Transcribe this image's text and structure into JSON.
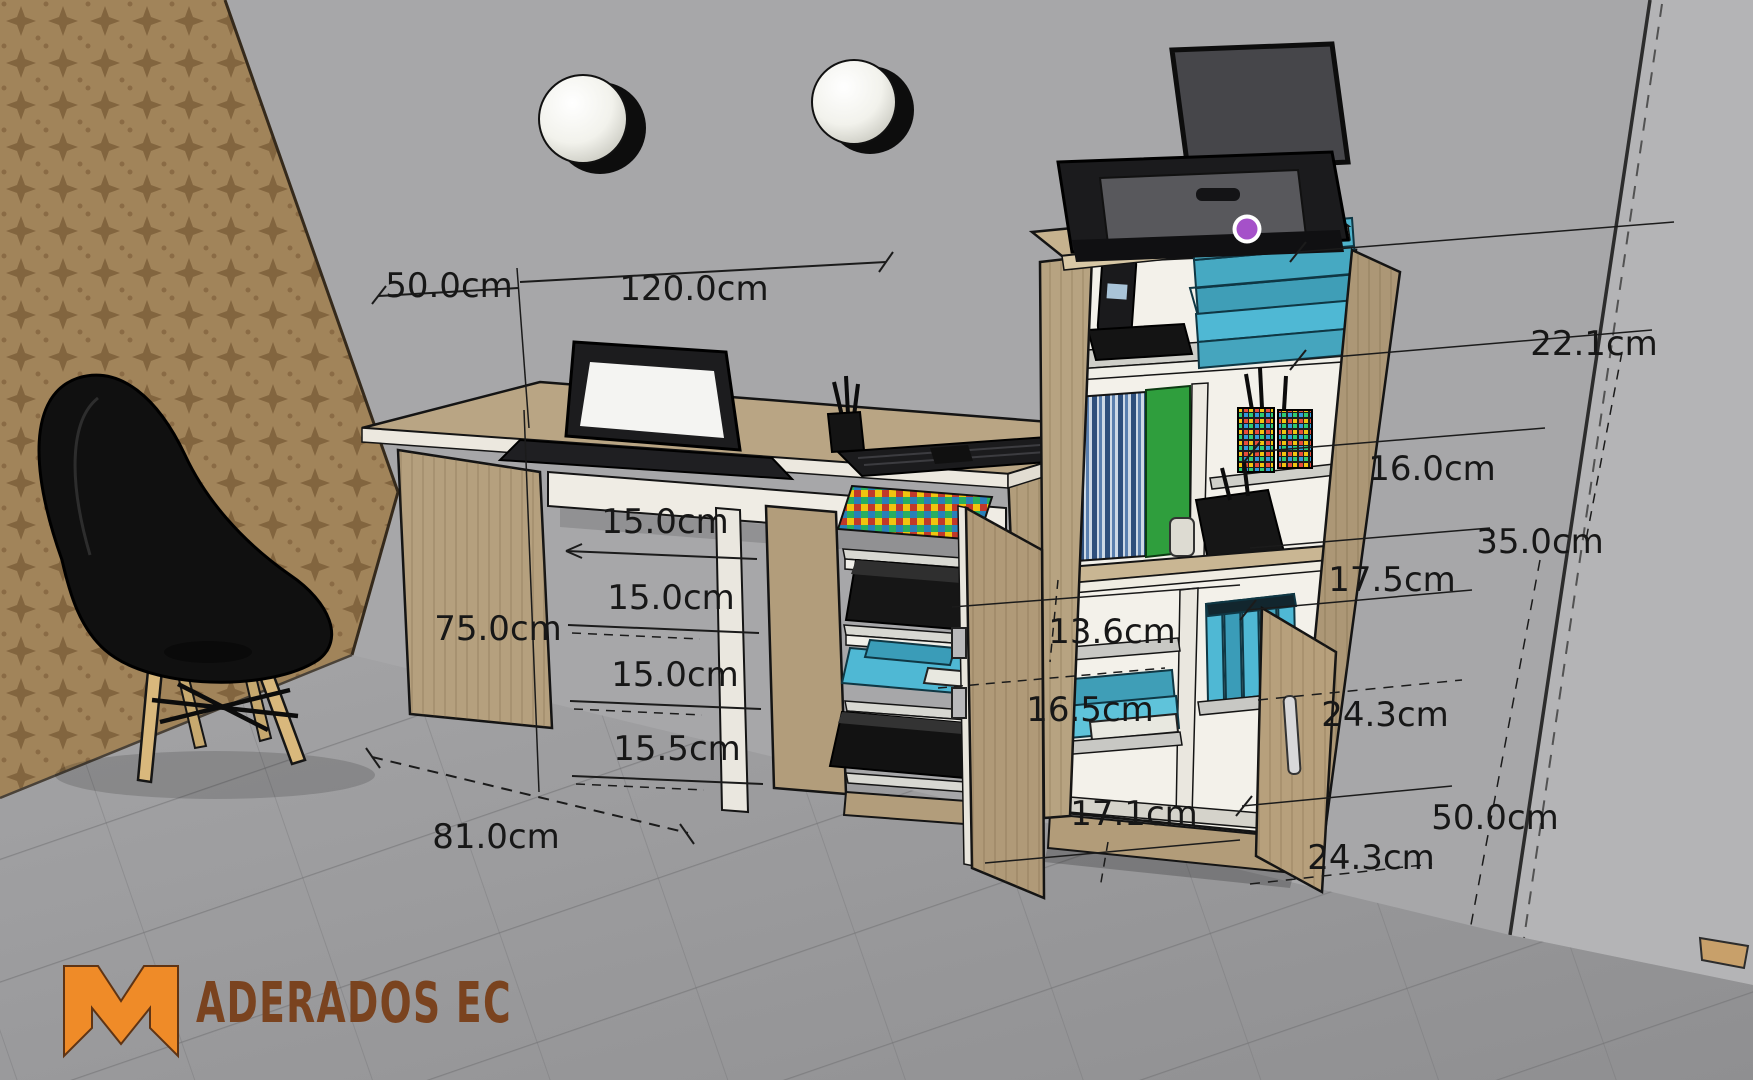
{
  "scene": {
    "description": "3D rendered home-office furniture set (desk, open shelf and storage cabinet) with dimension annotations",
    "units": "cm"
  },
  "brand": {
    "name": "MADERADOS EC",
    "monogram": "M",
    "wordmark": "ADERADOS EC",
    "orange": "#ef8b28",
    "brown": "#7a431f"
  },
  "measurements": {
    "wall_to_desk": "50.0cm",
    "desk_width": "120.0cm",
    "desk_height": "75.0cm",
    "desk_depth": "81.0cm",
    "desk_shelf_gap_1": "15.0cm",
    "desk_shelf_gap_2": "15.0cm",
    "desk_shelf_gap_3": "15.0cm",
    "desk_shelf_gap_4": "15.5cm",
    "cabinet_top_gap": "22.1cm",
    "cabinet_gap_16": "16.0cm",
    "cabinet_upper_section": "35.0cm",
    "cabinet_gap_17_5": "17.5cm",
    "cabinet_gap_13_6": "13.6cm",
    "cabinet_gap_16_5": "16.5cm",
    "cabinet_gap_17_1": "17.1cm",
    "cabinet_door_upper": "24.3cm",
    "cabinet_lower_section": "50.0cm",
    "cabinet_door_lower": "24.3cm"
  },
  "colors": {
    "back_wall": "#a7a7a9",
    "right_wall": "#b4b4b6",
    "floor": "#9b9b9d",
    "wallpaper": "#a1845a",
    "wood": "#b7a381",
    "white_panel": "#efece4",
    "teal": "#4fb8d4",
    "green": "#2f9e3d",
    "marker_purple": "#a551c9"
  }
}
